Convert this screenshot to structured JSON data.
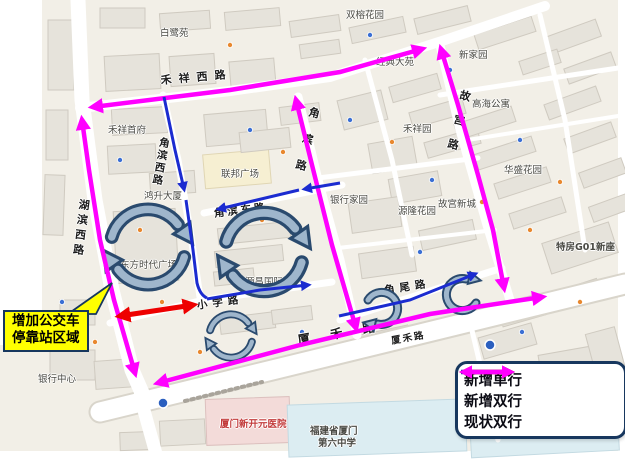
{
  "callout": {
    "line1": "增加公交车",
    "line2": "停靠站区域"
  },
  "legend": {
    "items": [
      {
        "id": "new-oneway",
        "label": "新增单行",
        "color": "#1B2BD0",
        "double": false
      },
      {
        "id": "new-twoway",
        "label": "新增双行",
        "color": "#EE0000",
        "double": true
      },
      {
        "id": "existing-twoway",
        "label": "现状双行",
        "color": "#FF00FF",
        "double": true
      }
    ]
  },
  "map": {
    "road_labels": [
      {
        "id": "hexiang-xi-road",
        "text": "禾祥西路",
        "x": 160,
        "y": 72,
        "rot": -5,
        "vert": false,
        "size": 11,
        "ls": 7
      },
      {
        "id": "hubin-xi-road",
        "text": "湖滨西路",
        "x": 76,
        "y": 198,
        "rot": 7,
        "vert": true,
        "size": 11,
        "ls": 4
      },
      {
        "id": "jiaobin-xi-road",
        "text": "角滨西路",
        "x": 158,
        "y": 136,
        "rot": 10,
        "vert": true,
        "size": 10.5,
        "ls": 2
      },
      {
        "id": "jiaobin-road",
        "text": "角滨路",
        "x": 307,
        "y": 105,
        "rot": 14,
        "vert": true,
        "size": 11,
        "ls": 16
      },
      {
        "id": "jiaobin-dong-road",
        "text": "角滨东路",
        "x": 213,
        "y": 206,
        "rot": -7,
        "vert": false,
        "size": 10.5,
        "ls": 3
      },
      {
        "id": "gugong-road",
        "text": "故宫路",
        "x": 458,
        "y": 88,
        "rot": 14,
        "vert": true,
        "size": 11,
        "ls": 14
      },
      {
        "id": "xiaoxue-road",
        "text": "小学路",
        "x": 196,
        "y": 298,
        "rot": -8,
        "vert": false,
        "size": 10.5,
        "ls": 5
      },
      {
        "id": "jiaowei-road",
        "text": "角尾路",
        "x": 383,
        "y": 283,
        "rot": -9,
        "vert": false,
        "size": 10.5,
        "ls": 5
      },
      {
        "id": "xiahe-road",
        "text": "厦 禾 路",
        "x": 296,
        "y": 330,
        "rot": -10,
        "vert": false,
        "size": 12.5,
        "ls": 8,
        "bold": true
      },
      {
        "id": "xiahe-road-small",
        "text": "厦禾路",
        "x": 390,
        "y": 333,
        "rot": -10,
        "vert": false,
        "size": 9.5,
        "ls": 2
      }
    ],
    "place_labels": [
      {
        "id": "bailu-yuan",
        "text": "白鹭苑",
        "x": 160,
        "y": 25
      },
      {
        "id": "shuangrong-garden",
        "text": "双榕花园",
        "x": 346,
        "y": 7
      },
      {
        "id": "jingdian-dayuan",
        "text": "经典大苑",
        "x": 376,
        "y": 54
      },
      {
        "id": "xin-jiayuan",
        "text": "新家园",
        "x": 459,
        "y": 47
      },
      {
        "id": "gaohai-apartment",
        "text": "高海公寓",
        "x": 472,
        "y": 96
      },
      {
        "id": "hexiang-yuan",
        "text": "禾祥园",
        "x": 403,
        "y": 121
      },
      {
        "id": "huasheng-garden",
        "text": "华盛花园",
        "x": 504,
        "y": 162
      },
      {
        "id": "gugong-xincheng",
        "text": "故宫新城",
        "x": 438,
        "y": 196
      },
      {
        "id": "yuanlong-garden",
        "text": "源隆花园",
        "x": 398,
        "y": 203
      },
      {
        "id": "yinhang-jiayuan",
        "text": "银行家园",
        "x": 330,
        "y": 192
      },
      {
        "id": "hexiang-shoufu",
        "text": "禾祥首府",
        "x": 108,
        "y": 122
      },
      {
        "id": "hongsheng-building",
        "text": "鸿升大厦",
        "x": 144,
        "y": 188
      },
      {
        "id": "dongfang-plaza",
        "text": "东方时代广场",
        "x": 120,
        "y": 257
      },
      {
        "id": "lianbang-plaza",
        "text": "联邦广场",
        "x": 221,
        "y": 166
      },
      {
        "id": "yuanchang-intl",
        "text": "源昌国际城",
        "x": 245,
        "y": 274
      },
      {
        "id": "yinhang-center",
        "text": "银行中心",
        "x": 38,
        "y": 371
      },
      {
        "id": "tefang-g01",
        "text": "特房G01新座",
        "x": 556,
        "y": 239,
        "bold": true
      },
      {
        "id": "xinkaiyuan-hospital",
        "text": "厦门新开元医院",
        "x": 220,
        "y": 416,
        "color": "#c23a3a",
        "bold": true
      },
      {
        "id": "school-line1",
        "text": "福建省厦门",
        "x": 310,
        "y": 423,
        "bold": true
      },
      {
        "id": "school-line2",
        "text": "第六中学",
        "x": 318,
        "y": 435,
        "bold": true
      }
    ]
  },
  "colors": {
    "new_oneway": "#1B2BD0",
    "new_twoway": "#EE0000",
    "existing_twoway": "#FF00FF",
    "loop_fill": "#9FB6CC",
    "loop_outline": "#2A4A6E",
    "callout_bg": "#FFFF00",
    "callout_border": "#17375E"
  }
}
